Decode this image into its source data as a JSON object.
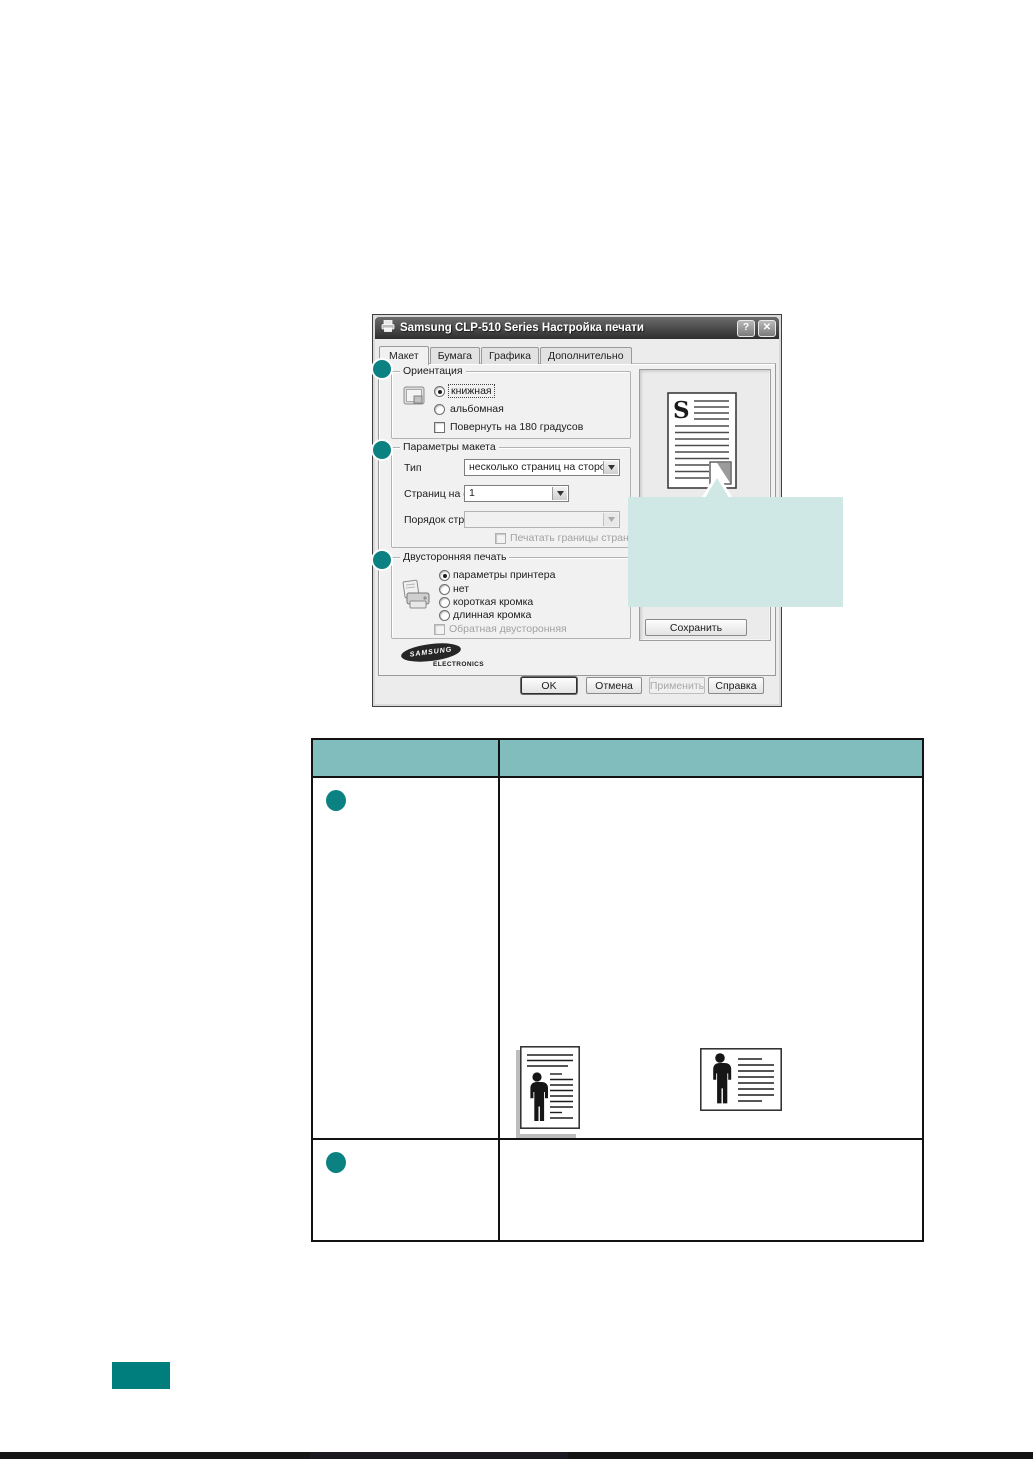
{
  "colors": {
    "accent_teal": "#0C8181",
    "table_header_teal": "#82BDBD",
    "callout_fill": "#CFE8E6",
    "page_badge_teal": "#007E7E"
  },
  "dialog": {
    "title": "Samsung CLP-510 Series Настройка печати",
    "titlebar": {
      "help_glyph": "?",
      "close_glyph": "✕"
    },
    "tabs": [
      {
        "label": "Макет"
      },
      {
        "label": "Бумага"
      },
      {
        "label": "Графика"
      },
      {
        "label": "Дополнительно"
      }
    ],
    "orientation": {
      "caption": "Ориентация",
      "portrait_label": "книжная",
      "landscape_label": "альбомная",
      "rotate_label": "Повернуть на 180 градусов"
    },
    "layout_options": {
      "caption": "Параметры макета",
      "type_label": "Тип",
      "type_value": "несколько страниц на стороне",
      "pages_per_side_label": "Страниц на стороне",
      "pages_per_side_value": "1",
      "page_order_label": "Порядок страниц",
      "page_order_value": "",
      "print_borders_label": "Печатать границы страниц"
    },
    "duplex": {
      "caption": "Двусторонняя печать",
      "options": [
        "параметры принтера",
        "нет",
        "короткая кромка",
        "длинная кромка"
      ],
      "reverse_label": "Обратная двусторонняя"
    },
    "preview": {
      "letter": "S",
      "save_button_label": "Сохранить"
    },
    "logo": {
      "brand": "SAMSUNG",
      "division": "ELECTRONICS"
    },
    "action_buttons": {
      "ok": "OK",
      "cancel": "Отмена",
      "apply": "Применить",
      "help": "Справка"
    }
  },
  "table": {
    "header": {
      "col1": "",
      "col2": ""
    },
    "row1": {
      "col1": "",
      "col2": ""
    },
    "row2": {
      "col1": "",
      "col2": ""
    }
  }
}
